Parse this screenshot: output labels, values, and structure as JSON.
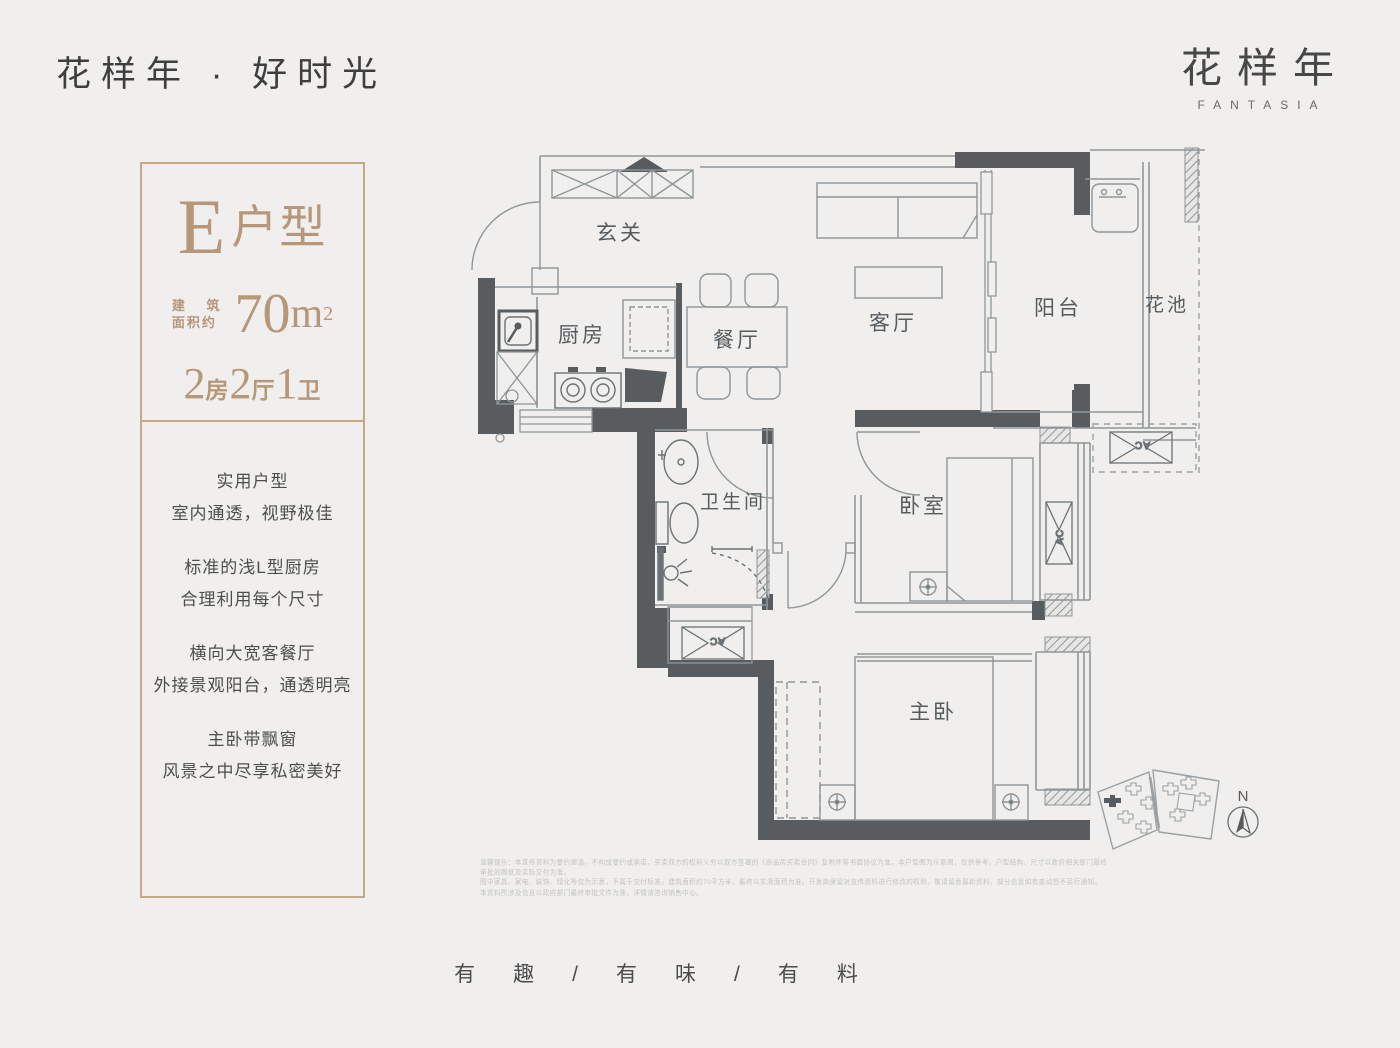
{
  "header": {
    "title": "花样年 · 好时光",
    "logo_cn": "花样年",
    "logo_en": "FANTASIA"
  },
  "panel": {
    "unit_letter": "E",
    "unit_suffix": "户型",
    "area_label_1": "建 筑",
    "area_label_2": "面积约",
    "area_value": "70",
    "area_unit": "m",
    "area_power": "2",
    "spec": [
      {
        "num": "2",
        "unit": "房"
      },
      {
        "num": "2",
        "unit": "厅"
      },
      {
        "num": "1",
        "unit": "卫"
      }
    ],
    "features": [
      [
        "实用户型",
        "室内通透，视野极佳"
      ],
      [
        "标准的浅L型厨房",
        "合理利用每个尺寸"
      ],
      [
        "横向大宽客餐厅",
        "外接景观阳台，通透明亮"
      ],
      [
        "主卧带飘窗",
        "风景之中尽享私密美好"
      ]
    ]
  },
  "floorplan": {
    "rooms": {
      "entry": "玄关",
      "kitchen": "厨房",
      "dining": "餐厅",
      "living": "客厅",
      "balcony": "阳台",
      "flowerbed": "花池",
      "bathroom": "卫生间",
      "bedroom": "卧室",
      "master": "主卧"
    },
    "ac_label": "AC",
    "compass_n": "N"
  },
  "disclaimer": [
    "温馨提示：本宣传资料为要约邀请，不构成要约或承诺，买卖双方的权利义务以双方签署的《商品房买卖合同》及附件等书面协议为准。本户型图为示意图，仅供参考，户型结构、尺寸以政府相关部门最终审批的图纸及实际交付为准。",
    "图中家具、家电、装饰、绿化等仅为示意，不属于交付标准。建筑面积约70平方米，最终以实测面积为准。开发商保留对宣传资料进行修改的权利，敬请留意最新资料，部分信息如有变动恕不另行通知。",
    "本资料所涉及信息以政府部门最终审批文件为准，详情请咨询销售中心。"
  ],
  "footer": {
    "slogan": "有趣/有味/有料"
  },
  "colors": {
    "background": "#f0efed",
    "wall": "#585c5f",
    "line": "#8f969a",
    "accent_tan": "#b7977a",
    "panel_border": "#c6a787"
  }
}
